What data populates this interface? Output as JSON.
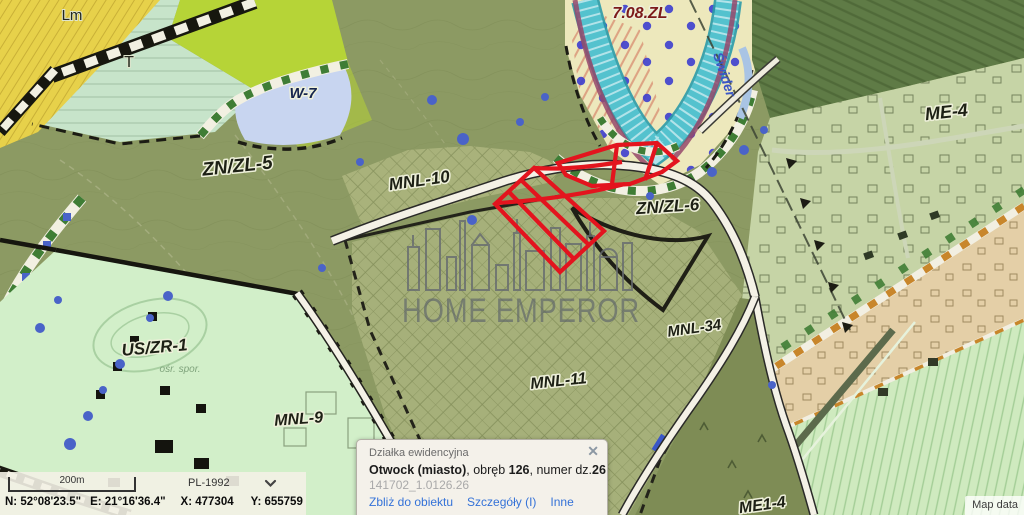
{
  "map": {
    "zones": [
      {
        "id": "Lm"
      },
      {
        "id": "T"
      },
      {
        "id": "W-7"
      },
      {
        "id": "ZN/ZL-5"
      },
      {
        "id": "MNL-10"
      },
      {
        "id": "7.08.ZL"
      },
      {
        "id": "ZN/ZL-6"
      },
      {
        "id": "ME-4"
      },
      {
        "id": "MNL-34"
      },
      {
        "id": "MNL-11"
      },
      {
        "id": "MNL-9"
      },
      {
        "id": "US/ZR-1"
      },
      {
        "id": "ME1-4"
      }
    ],
    "river_label": "Świder",
    "area_note": "ośr. spor.",
    "watermark": "HOME EMPEROR",
    "attribution": "Map data",
    "colors": {
      "base_olive": "#8c9a63",
      "zone_light_olive": "#a6b07a",
      "zone_mint": "#c7e4ca",
      "zone_lime": "#b6d437",
      "zone_yellow": "#e7d14a",
      "zone_us_mint": "#d2efc9",
      "zone_me4": "#c6d4a6",
      "zone_forest_dark": "#5f7b46",
      "zone_forest_light": "#cfeabf",
      "zone_corridor_tan": "#e4cfa7",
      "corridor_orange": "#c8862b",
      "water_lavender": "#c8d5f0",
      "river_teal": "#54c2ce",
      "river_cream": "#ede8bc",
      "selected_parcel_red": "#e3141e",
      "road_fill": "#f4f1e6",
      "link_blue": "#3472d8"
    }
  },
  "popup": {
    "title": "Działka ewidencyjna",
    "close_glyph": "✕",
    "location": {
      "name": "Otwock (miasto)",
      "sep1": ", obręb ",
      "precinct": "126",
      "sep2": ", numer dz.",
      "parcel": "26"
    },
    "ident": "141702_1.0126.26",
    "links": [
      "Zbliż do obiektu",
      "Szczegóły (I)",
      "Inne"
    ]
  },
  "statusbar": {
    "scale_label": "200m",
    "crs": "PL-1992",
    "coord_n": "N: 52°08'23.5\"",
    "coord_e": "E: 21°16'36.4\"",
    "coord_x": "X: 477304",
    "coord_y": "Y: 655759"
  }
}
